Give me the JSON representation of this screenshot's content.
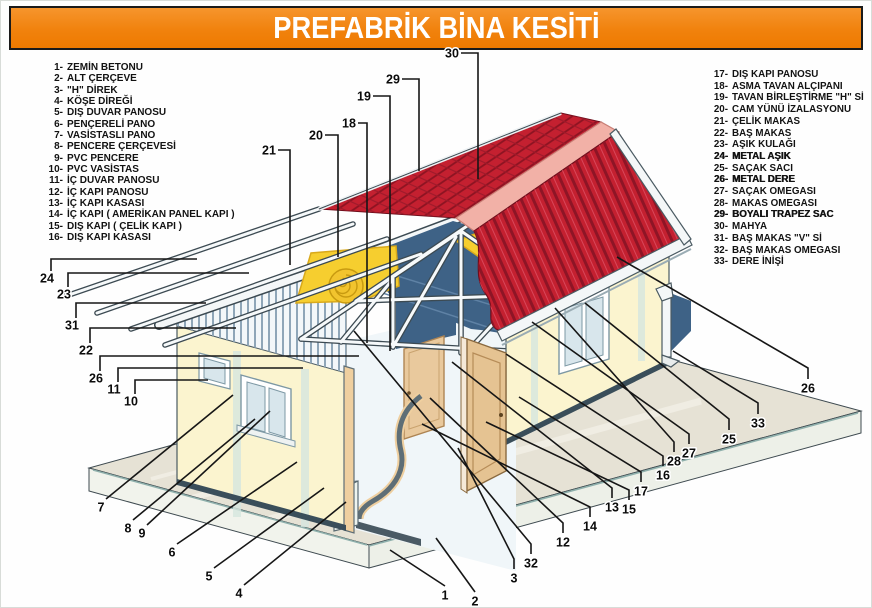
{
  "title": "PREFABRİK BİNA KESİTİ",
  "colors": {
    "banner_orange": "#f1820d",
    "roof_red": "#c42030",
    "roof_hatch_dark": "#8c1322",
    "ridge_pink": "#f2b1a7",
    "ceiling_blue": "#3e6286",
    "insulation_yellow": "#f6ce2f",
    "wall_cream": "#fbf4cf",
    "slab_gray": "#e6e2d5",
    "leader_black": "#161616"
  },
  "legend_left": [
    {
      "num": "1-",
      "label": "ZEMİN BETONU"
    },
    {
      "num": "2-",
      "label": "ALT ÇERÇEVE"
    },
    {
      "num": "3-",
      "label": "\"H\" DİREK"
    },
    {
      "num": "4-",
      "label": "KÖŞE DİREĞİ"
    },
    {
      "num": "5-",
      "label": "DIŞ DUVAR PANOSU"
    },
    {
      "num": "6-",
      "label": "PENÇERELİ PANO"
    },
    {
      "num": "7-",
      "label": "VASİSTASLI PANO"
    },
    {
      "num": "8-",
      "label": "PENCERE ÇERÇEVESİ"
    },
    {
      "num": "9-",
      "label": "PVC PENCERE"
    },
    {
      "num": "10-",
      "label": "PVC VASİSTAS"
    },
    {
      "num": "11-",
      "label": "İÇ DUVAR PANOSU"
    },
    {
      "num": "12-",
      "label": "İÇ KAPI PANOSU"
    },
    {
      "num": "13-",
      "label": "İÇ KAPI KASASI"
    },
    {
      "num": "14-",
      "label": "İÇ KAPI   ( AMERİKAN PANEL KAPI )"
    },
    {
      "num": "15-",
      "label": "DIŞ KAPI ( ÇELİK KAPI )"
    },
    {
      "num": "16-",
      "label": "DIŞ KAPI KASASI"
    }
  ],
  "legend_right": [
    {
      "num": "17-",
      "label": "DIŞ KAPI PANOSU"
    },
    {
      "num": "18-",
      "label": "ASMA TAVAN ALÇIPANI"
    },
    {
      "num": "19-",
      "label": "TAVAN BİRLEŞTİRME \"H\" Sİ"
    },
    {
      "num": "20-",
      "label": "CAM YÜNÜ İZALASYONU"
    },
    {
      "num": "21-",
      "label": "ÇELİK MAKAS"
    },
    {
      "num": "22-",
      "label": "BAŞ MAKAS"
    },
    {
      "num": "23-",
      "label": "AŞIK KULAĞI"
    },
    {
      "num": "24-",
      "label": "METAL AŞIK",
      "em": true
    },
    {
      "num": "25-",
      "label": "SAÇAK SACI"
    },
    {
      "num": "26-",
      "label": "METAL DERE",
      "em": true
    },
    {
      "num": "27-",
      "label": "SAÇAK OMEGASI"
    },
    {
      "num": "28-",
      "label": "MAKAS OMEGASI"
    },
    {
      "num": "29-",
      "label": "BOYALI TRAPEZ SAC",
      "em": true
    },
    {
      "num": "30-",
      "label": "MAHYA"
    },
    {
      "num": "31-",
      "label": "BAŞ MAKAS \"V\" Sİ"
    },
    {
      "num": "32-",
      "label": "BAŞ MAKAS OMEGASI"
    },
    {
      "num": "33-",
      "label": "DERE İNİŞİ"
    }
  ],
  "callouts": [
    {
      "n": "30",
      "x": 451,
      "y": 52,
      "line": [
        [
          460,
          52
        ],
        [
          477,
          52
        ],
        [
          477,
          178
        ]
      ]
    },
    {
      "n": "29",
      "x": 392,
      "y": 78,
      "line": [
        [
          401,
          78
        ],
        [
          418,
          78
        ],
        [
          418,
          170
        ]
      ]
    },
    {
      "n": "19",
      "x": 363,
      "y": 95,
      "line": [
        [
          372,
          95
        ],
        [
          389,
          95
        ],
        [
          389,
          350
        ]
      ]
    },
    {
      "n": "18",
      "x": 348,
      "y": 122,
      "line": [
        [
          357,
          122
        ],
        [
          366,
          122
        ],
        [
          366,
          342
        ]
      ]
    },
    {
      "n": "20",
      "x": 315,
      "y": 134,
      "line": [
        [
          324,
          134
        ],
        [
          337,
          134
        ],
        [
          337,
          256
        ]
      ]
    },
    {
      "n": "21",
      "x": 268,
      "y": 149,
      "line": [
        [
          277,
          149
        ],
        [
          289,
          149
        ],
        [
          289,
          264
        ]
      ]
    },
    {
      "n": "24",
      "x": 46,
      "y": 277,
      "line": [
        [
          50,
          270
        ],
        [
          50,
          258
        ],
        [
          196,
          258
        ]
      ]
    },
    {
      "n": "23",
      "x": 63,
      "y": 293,
      "line": [
        [
          67,
          286
        ],
        [
          67,
          272
        ],
        [
          248,
          272
        ]
      ]
    },
    {
      "n": "31",
      "x": 71,
      "y": 324,
      "line": [
        [
          75,
          317
        ],
        [
          75,
          302
        ],
        [
          205,
          302
        ]
      ]
    },
    {
      "n": "22",
      "x": 85,
      "y": 349,
      "line": [
        [
          89,
          342
        ],
        [
          89,
          327
        ],
        [
          235,
          327
        ]
      ]
    },
    {
      "n": "26",
      "x": 95,
      "y": 377,
      "line": [
        [
          99,
          370
        ],
        [
          99,
          355
        ],
        [
          358,
          355
        ]
      ]
    },
    {
      "n": "11",
      "x": 113,
      "y": 388,
      "line": [
        [
          117,
          381
        ],
        [
          117,
          367
        ],
        [
          302,
          367
        ]
      ]
    },
    {
      "n": "10",
      "x": 130,
      "y": 400,
      "line": [
        [
          134,
          393
        ],
        [
          134,
          379
        ],
        [
          207,
          379
        ]
      ]
    },
    {
      "n": "7",
      "x": 100,
      "y": 506,
      "line": [
        [
          105,
          498
        ],
        [
          232,
          394
        ]
      ]
    },
    {
      "n": "8",
      "x": 127,
      "y": 527,
      "line": [
        [
          132,
          519
        ],
        [
          254,
          418
        ]
      ]
    },
    {
      "n": "9",
      "x": 141,
      "y": 532,
      "line": [
        [
          146,
          524
        ],
        [
          269,
          410
        ]
      ]
    },
    {
      "n": "6",
      "x": 171,
      "y": 551,
      "line": [
        [
          176,
          543
        ],
        [
          296,
          461
        ]
      ]
    },
    {
      "n": "5",
      "x": 208,
      "y": 575,
      "line": [
        [
          213,
          567
        ],
        [
          323,
          487
        ]
      ]
    },
    {
      "n": "4",
      "x": 238,
      "y": 592,
      "line": [
        [
          243,
          584
        ],
        [
          345,
          501
        ]
      ]
    },
    {
      "n": "1",
      "x": 444,
      "y": 594,
      "line": [
        [
          444,
          585
        ],
        [
          389,
          549
        ]
      ]
    },
    {
      "n": "2",
      "x": 474,
      "y": 600,
      "line": [
        [
          474,
          591
        ],
        [
          435,
          537
        ]
      ]
    },
    {
      "n": "3",
      "x": 513,
      "y": 577,
      "line": [
        [
          513,
          568
        ],
        [
          513,
          558
        ],
        [
          457,
          447
        ]
      ]
    },
    {
      "n": "32",
      "x": 530,
      "y": 562,
      "line": [
        [
          530,
          553
        ],
        [
          530,
          543
        ],
        [
          353,
          330
        ]
      ]
    },
    {
      "n": "12",
      "x": 562,
      "y": 541,
      "line": [
        [
          562,
          532
        ],
        [
          562,
          522
        ],
        [
          429,
          397
        ]
      ]
    },
    {
      "n": "14",
      "x": 589,
      "y": 525,
      "line": [
        [
          589,
          516
        ],
        [
          589,
          506
        ],
        [
          421,
          423
        ]
      ]
    },
    {
      "n": "13",
      "x": 611,
      "y": 506,
      "line": [
        [
          611,
          497
        ],
        [
          611,
          487
        ],
        [
          451,
          361
        ]
      ]
    },
    {
      "n": "15",
      "x": 628,
      "y": 508,
      "line": [
        [
          628,
          499
        ],
        [
          628,
          489
        ],
        [
          485,
          421
        ]
      ]
    },
    {
      "n": "17",
      "x": 640,
      "y": 490,
      "line": [
        [
          640,
          481
        ],
        [
          640,
          471
        ],
        [
          518,
          396
        ]
      ]
    },
    {
      "n": "16",
      "x": 662,
      "y": 474,
      "line": [
        [
          662,
          465
        ],
        [
          662,
          455
        ],
        [
          505,
          353
        ]
      ]
    },
    {
      "n": "28",
      "x": 673,
      "y": 460,
      "line": [
        [
          673,
          451
        ],
        [
          673,
          441
        ],
        [
          554,
          307
        ]
      ]
    },
    {
      "n": "27",
      "x": 688,
      "y": 452,
      "line": [
        [
          688,
          443
        ],
        [
          688,
          433
        ],
        [
          531,
          321
        ]
      ]
    },
    {
      "n": "25",
      "x": 728,
      "y": 438,
      "line": [
        [
          728,
          429
        ],
        [
          728,
          418
        ],
        [
          584,
          302
        ]
      ]
    },
    {
      "n": "33",
      "x": 757,
      "y": 422,
      "line": [
        [
          757,
          413
        ],
        [
          757,
          402
        ],
        [
          672,
          350
        ]
      ]
    },
    {
      "n": "26",
      "x": 807,
      "y": 387,
      "line": [
        [
          807,
          378
        ],
        [
          807,
          367
        ],
        [
          616,
          256
        ]
      ]
    }
  ]
}
